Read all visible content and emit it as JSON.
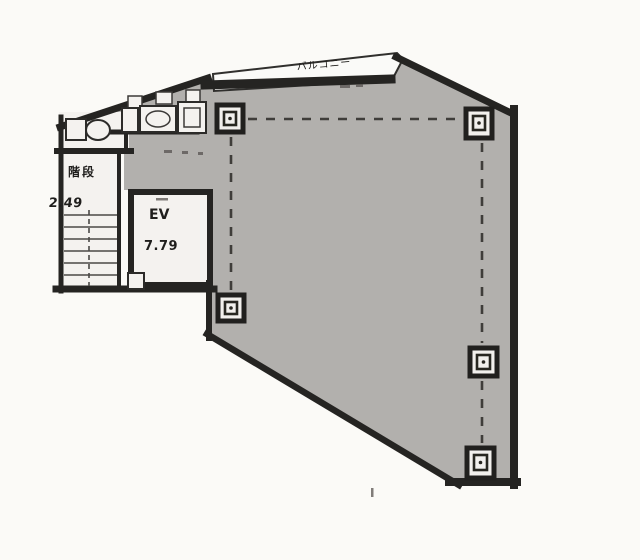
{
  "labels": {
    "balcony": "バルコニー",
    "stairs": "階段",
    "stairs_area": "2.49",
    "elevator": "EV",
    "elevator_area": "7.79"
  },
  "colors": {
    "background": "#fbfaf7",
    "floor_fill": "#b3b1ae",
    "room_fill": "#f6f4f1",
    "wall": "#232220",
    "grid_line": "#3e3c39",
    "balcony_fill": "#fdfcfa"
  }
}
